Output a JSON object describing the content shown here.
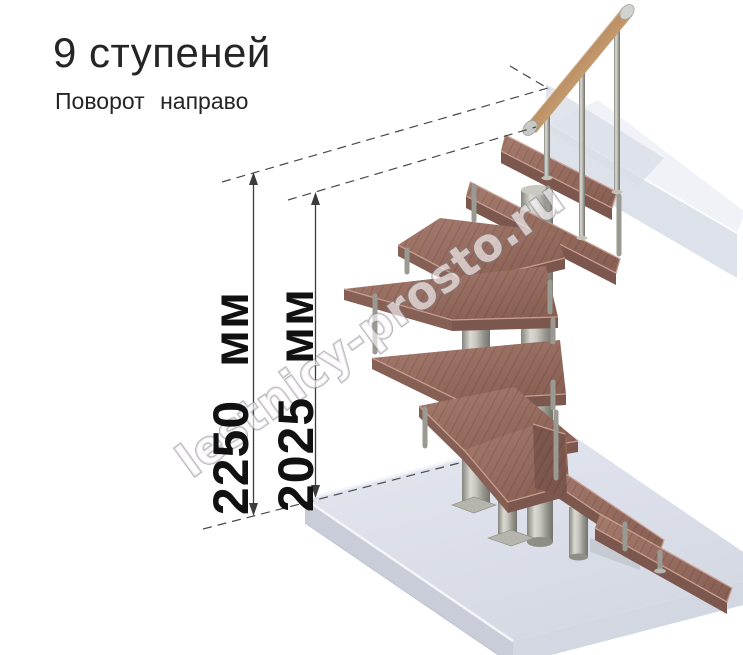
{
  "header": {
    "title": "9 ступеней",
    "subtitle": "Поворот направо"
  },
  "dimensions": [
    {
      "id": "overall-height",
      "label": "2250 мм",
      "value": 2250,
      "unit": "мм"
    },
    {
      "id": "height-to-top-step",
      "label": "2025 мм",
      "value": 2025,
      "unit": "мм"
    }
  ],
  "staircase": {
    "steps_count": 9,
    "turn_direction": "направо",
    "colors": {
      "tread_wood": "#9a7064",
      "handrail_wood": "#a06a48",
      "metal": "#b9b9b2",
      "floor_slab": "#dde1ea",
      "dimension_lines": "#3c3c3c"
    }
  },
  "watermark": {
    "text": "lestnicy-prosto.ru"
  }
}
